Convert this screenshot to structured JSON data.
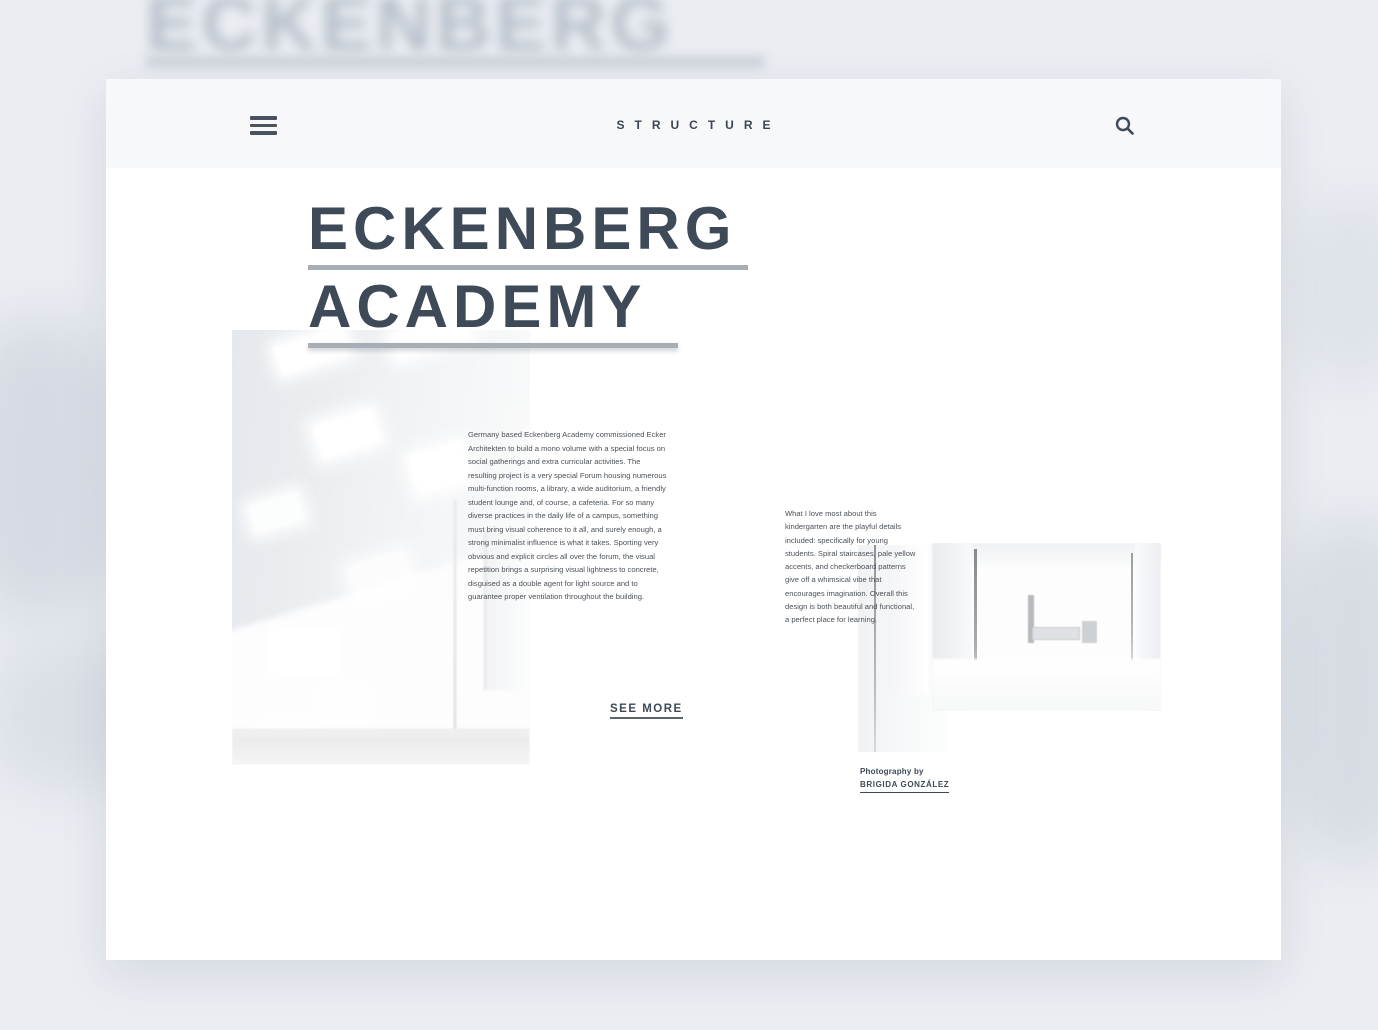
{
  "background": {
    "echo_title": "ECKENBERG"
  },
  "header": {
    "brand": "STRUCTURE"
  },
  "article": {
    "title_line1": "ECKENBERG",
    "title_line2": "ACADEMY",
    "body": "Germany based Eckenberg Academy commissioned Ecker Architekten to build a mono volume with a special focus on social gatherings and extra curricular activities. The resulting project is a very special Forum housing numerous multi-function rooms, a library, a wide auditorium, a friendly student lounge and, of course, a cafeteria. For so many diverse practices in the daily life of a campus, something must bring visual coherence to it all, and surely enough, a strong minimalist influence is what it takes. Sporting very obvious and explicit circles all over the forum, the visual repetition brings a surprising visual lightness to concrete, disguised as a double agent for light source and to guarantee proper ventilation throughout the building.",
    "see_more_label": "SEE MORE",
    "sidebar_text": "What I love most about this kindergarten are the playful details included: specifically for young students. Spiral staircases, pale yellow accents, and checkerboard patterns give off a whimsical vibe that encourages imagination. Overall this design is both beautiful and functional, a perfect place for learning.",
    "credit_label": "Photography by",
    "credit_name": "BRIGIDA GONZÁLEZ"
  },
  "icons": {
    "menu": "hamburger-icon",
    "search": "search-icon"
  },
  "colors": {
    "page_bg": "#eaedf2",
    "card_bg": "#ffffff",
    "header_bg": "#f7f8fa",
    "ink": "#3e4a57",
    "rule_gray": "#a8aeb6",
    "body_text": "#4c525a"
  }
}
